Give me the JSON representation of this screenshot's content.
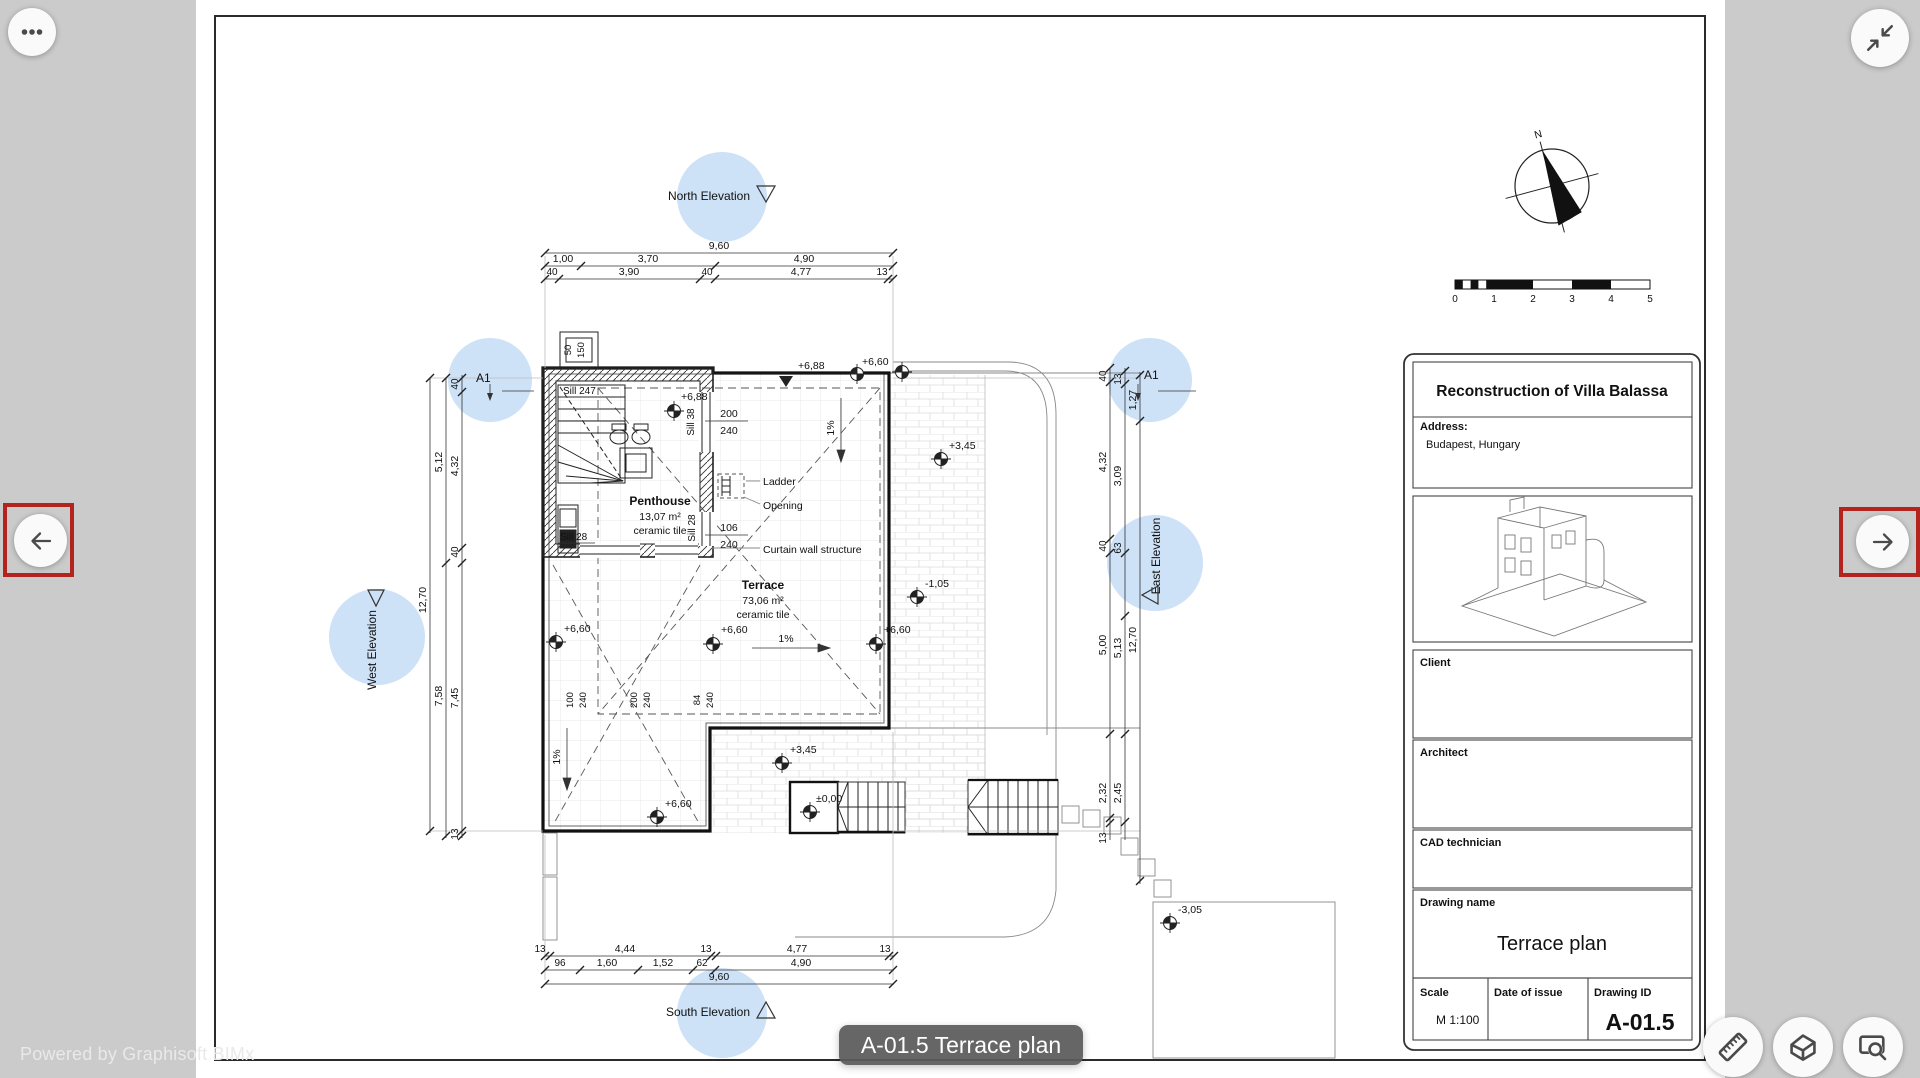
{
  "viewer": {
    "powered_by": "Powered by Graphisoft BIMx",
    "tooltip": "A-01.5 Terrace plan",
    "accent_red": "#b3241e",
    "hotspot_blue": "#c9def6",
    "background_gray": "#cbcbcb",
    "icons": {
      "menu": "ellipsis",
      "collapse": "collapse-arrows",
      "prev": "arrow-left",
      "next": "arrow-right",
      "measure": "ruler",
      "model": "house-3d",
      "zoom_window": "screen-magnifier"
    }
  },
  "titleblock": {
    "project": "Reconstruction of Villa Balassa",
    "address_label": "Address:",
    "address": "Budapest, Hungary",
    "client_label": "Client",
    "architect_label": "Architect",
    "cad_label": "CAD technician",
    "drawing_name_label": "Drawing name",
    "drawing_name": "Terrace plan",
    "scale_label": "Scale",
    "scale": "M 1:100",
    "date_label": "Date of issue",
    "id_label": "Drawing ID",
    "drawing_id": "A-01.5"
  },
  "compass": {
    "north": "N"
  },
  "scalebar": {
    "ticks": [
      "0",
      "1",
      "2",
      "3",
      "4",
      "5"
    ]
  },
  "plan": {
    "markers": {
      "north": "North Elevation",
      "south": "South Elevation",
      "west": "West Elevation",
      "east": "East Elevation",
      "section_left": "A1",
      "section_right": "A1"
    },
    "rooms": {
      "penthouse": {
        "name": "Penthouse",
        "area": "13,07 m²",
        "finish": "ceramic tile"
      },
      "terrace": {
        "name": "Terrace",
        "area": "73,06 m²",
        "finish": "ceramic tile"
      }
    },
    "ann": {
      "ladder": "Ladder",
      "opening": "Opening",
      "curtain": "Curtain wall structure",
      "sill247": "Sill 247",
      "sill38": "Sill 38",
      "sill28a": "Sill 28",
      "sill28b": "Sill 28",
      "w1a": "200",
      "w1b": "240",
      "w2a": "106",
      "w2b": "240",
      "slope": "1%"
    },
    "levels": {
      "p688a": "+6,88",
      "p688b": "+6,88",
      "p660a": "+6,60",
      "p660b": "+6,60",
      "p660c": "+6,60",
      "p660d": "+6,60",
      "p660e": "+6,60",
      "p345a": "+3,45",
      "p345b": "+3,45",
      "m105": "-1,05",
      "zero": "±0,00",
      "m305": "-3,05"
    },
    "dims": {
      "top": {
        "total": "9,60",
        "row2": [
          "1,00",
          "3,70",
          "4,90"
        ],
        "row3": [
          "40",
          "3,90",
          "40",
          "4,77",
          "13"
        ]
      },
      "bottom": {
        "row1": [
          "13",
          "4,44",
          "13",
          "4,77",
          "13"
        ],
        "row2": [
          "96",
          "1,60",
          "1,52",
          "62",
          "4,90"
        ],
        "total": "9,60"
      },
      "west": {
        "total": "12,70",
        "mid": [
          "5,12",
          "7,58"
        ],
        "inner": [
          "40",
          "4,32",
          "40",
          "7,45",
          "13"
        ]
      },
      "east": {
        "outer": [
          "40",
          "4,32",
          "40",
          "5,00",
          "2,32",
          "13"
        ],
        "mid": [
          "13",
          "3,09",
          "63",
          "5,13",
          "2,45"
        ],
        "inner": [
          "1,27",
          "12,70"
        ]
      },
      "entry": [
        "50",
        "150"
      ],
      "interior": [
        "100",
        "240",
        "200",
        "240",
        "84",
        "240"
      ]
    }
  }
}
